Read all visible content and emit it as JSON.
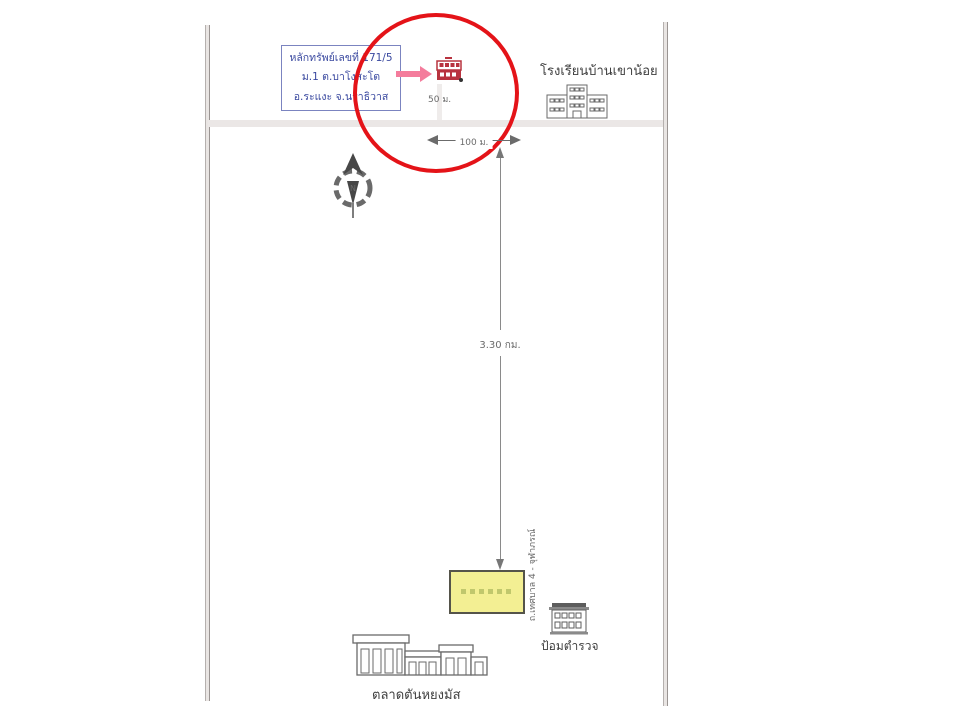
{
  "map": {
    "property_box": {
      "line1": "หลักทรัพย์เลขที่ 171/5",
      "line2": "ม.1 ต.บาโงสะโต",
      "line3": "อ.ระแงะ จ.นราธิวาส"
    },
    "property_access_distance": "50 ม.",
    "road_frontage_distance": "100 ม.",
    "route_distance": "3.30 กม.",
    "compass": {
      "label": "N"
    },
    "school": {
      "name": "โรงเรียนบ้านเขาน้อย"
    },
    "police_box": {
      "name": "ป้อมตำรวจ"
    },
    "market": {
      "name": "ตลาดตันหยงมัส"
    },
    "vertical_road": {
      "name": "ถ.เทศบาล 4 - จุฬาภรณ์"
    }
  },
  "colors": {
    "highlight_circle": "#e41318",
    "pointer_arrow": "#f47c9c",
    "subject_building": "#b8333f",
    "info_box_text": "#39489f",
    "info_box_border": "#7b84c0",
    "landmark_fill": "#f3ef93",
    "line_gray": "#6b6b6b"
  }
}
